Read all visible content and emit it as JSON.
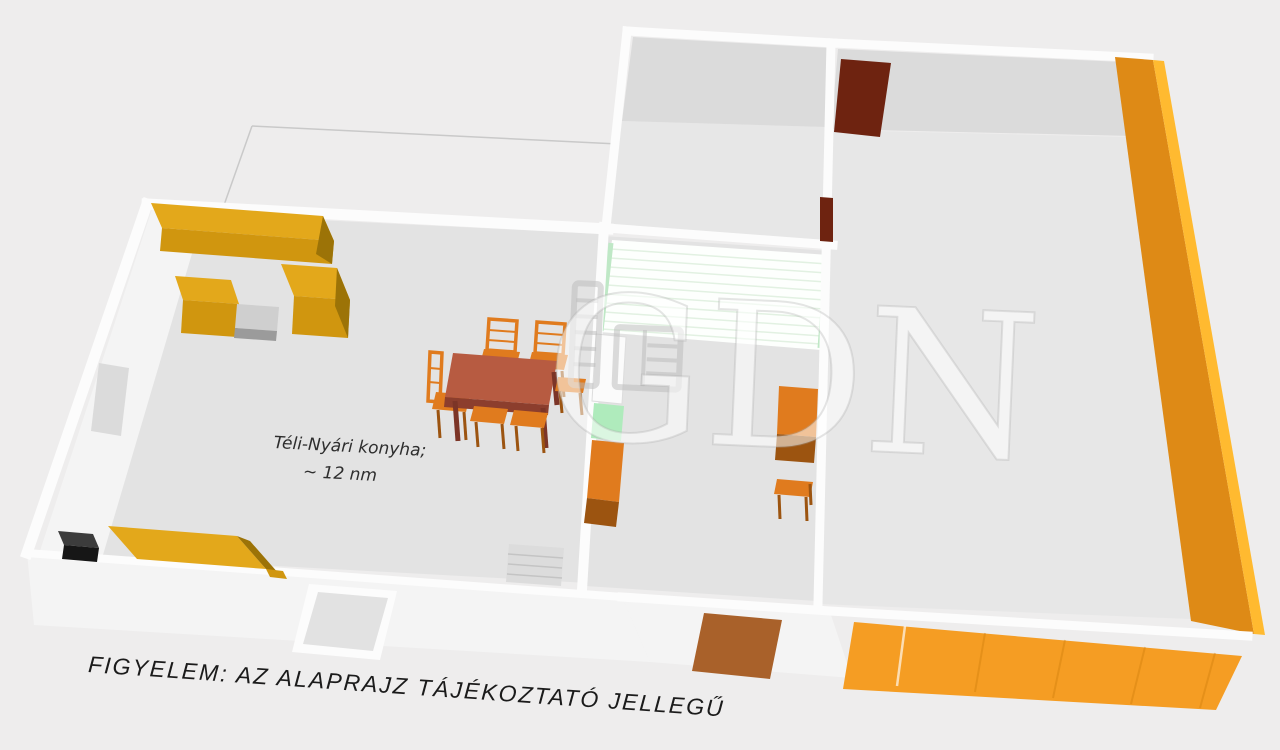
{
  "scene": {
    "type": "3d-floor-plan",
    "room_label": {
      "line1": "Téli-Nyári konyha;",
      "line2": "~ 12 nm"
    },
    "disclaimer": "FIGYELEM: AZ ALAPRAJZ TÁJÉKOZTATÓ JELLEGŰ",
    "watermark": {
      "text": "GDN",
      "logo": "ladder-building-logo"
    }
  },
  "colors": {
    "floor": "#E3E3E3",
    "floor_right": "#E7E7E7",
    "wall_face": "#F4F4F4",
    "back_wall_face": "#DBDBDB",
    "window_gray": "#DBDBDB",
    "door_inner_gray": "#E2E2E2",
    "cabinet_top": "#E3A81B",
    "cabinet_front": "#D0960F",
    "cabinet_side": "#9C7307",
    "counter_gray_top": "#CFCFCF",
    "counter_gray_front": "#9B9B9B",
    "table_top": "#B75B41",
    "table_edge": "#8C3E2D",
    "table_leg": "#7C3527",
    "chair": "#E07B1E",
    "chair_dark": "#9C5410",
    "appliance_top": "#3C3C3C",
    "appliance_front": "#161616",
    "mint": "#AFEBBC",
    "panel_fill": "#FDFFFD",
    "panel_line": "#E2F1E2",
    "panel_edge": "#BFE8C6",
    "steps_gray": "#DCDCDC",
    "steps_line": "#C4C4C4",
    "door_maroon": "#6E2310",
    "door_brown": "#A9612A",
    "side_wall_orange": "#DE8A16",
    "side_wall_edge": "#FFBA30",
    "front_panel_orange": "#F59D23",
    "white_box": "#FBFBFB",
    "text_label": "#2E2E2E",
    "text_dark": "#1B1B1B",
    "watermark_fill": "rgba(255,255,255,0.55)"
  }
}
